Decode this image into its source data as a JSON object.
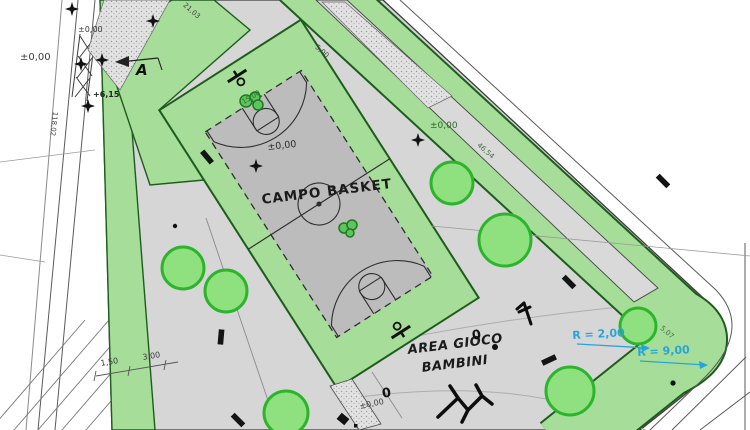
{
  "labels": {
    "court_title": "CAMPO BASKET",
    "play_area_line1": "AREA GIOCO",
    "play_area_line2": "BAMBINI",
    "section_marker": "A"
  },
  "elevations": {
    "road_west": "±0,00",
    "entrance_path": "±0,00",
    "court": "±0,00",
    "path_east": "±0,00",
    "entrance_south": "±0,00",
    "stair_top": "+6,15"
  },
  "radii": {
    "inner_corner": "R = 2,00",
    "outer_corner": "R = 9,00"
  },
  "dimensions": {
    "strip_top": "21,03",
    "road_west_length": "118,02",
    "boundary_east": "46,54",
    "sidewalk_width": "1,50",
    "verge_width": "3,00",
    "court_width": "15,00",
    "path_width": "5,00",
    "corner_offset": "5,07"
  },
  "markers": {
    "post_east": "0",
    "post_south": "0"
  },
  "colors": {
    "lawn_green": "#a5dd99",
    "green_border": "#1e5c1e",
    "tree_fill": "#8fe07e",
    "tree_stroke": "#2cb52c",
    "paving_gray": "#d6d6d6",
    "court_field_gray": "#bcbcbc",
    "line_dark": "#3c3c3c",
    "dimension_blue": "#29a4d9"
  }
}
